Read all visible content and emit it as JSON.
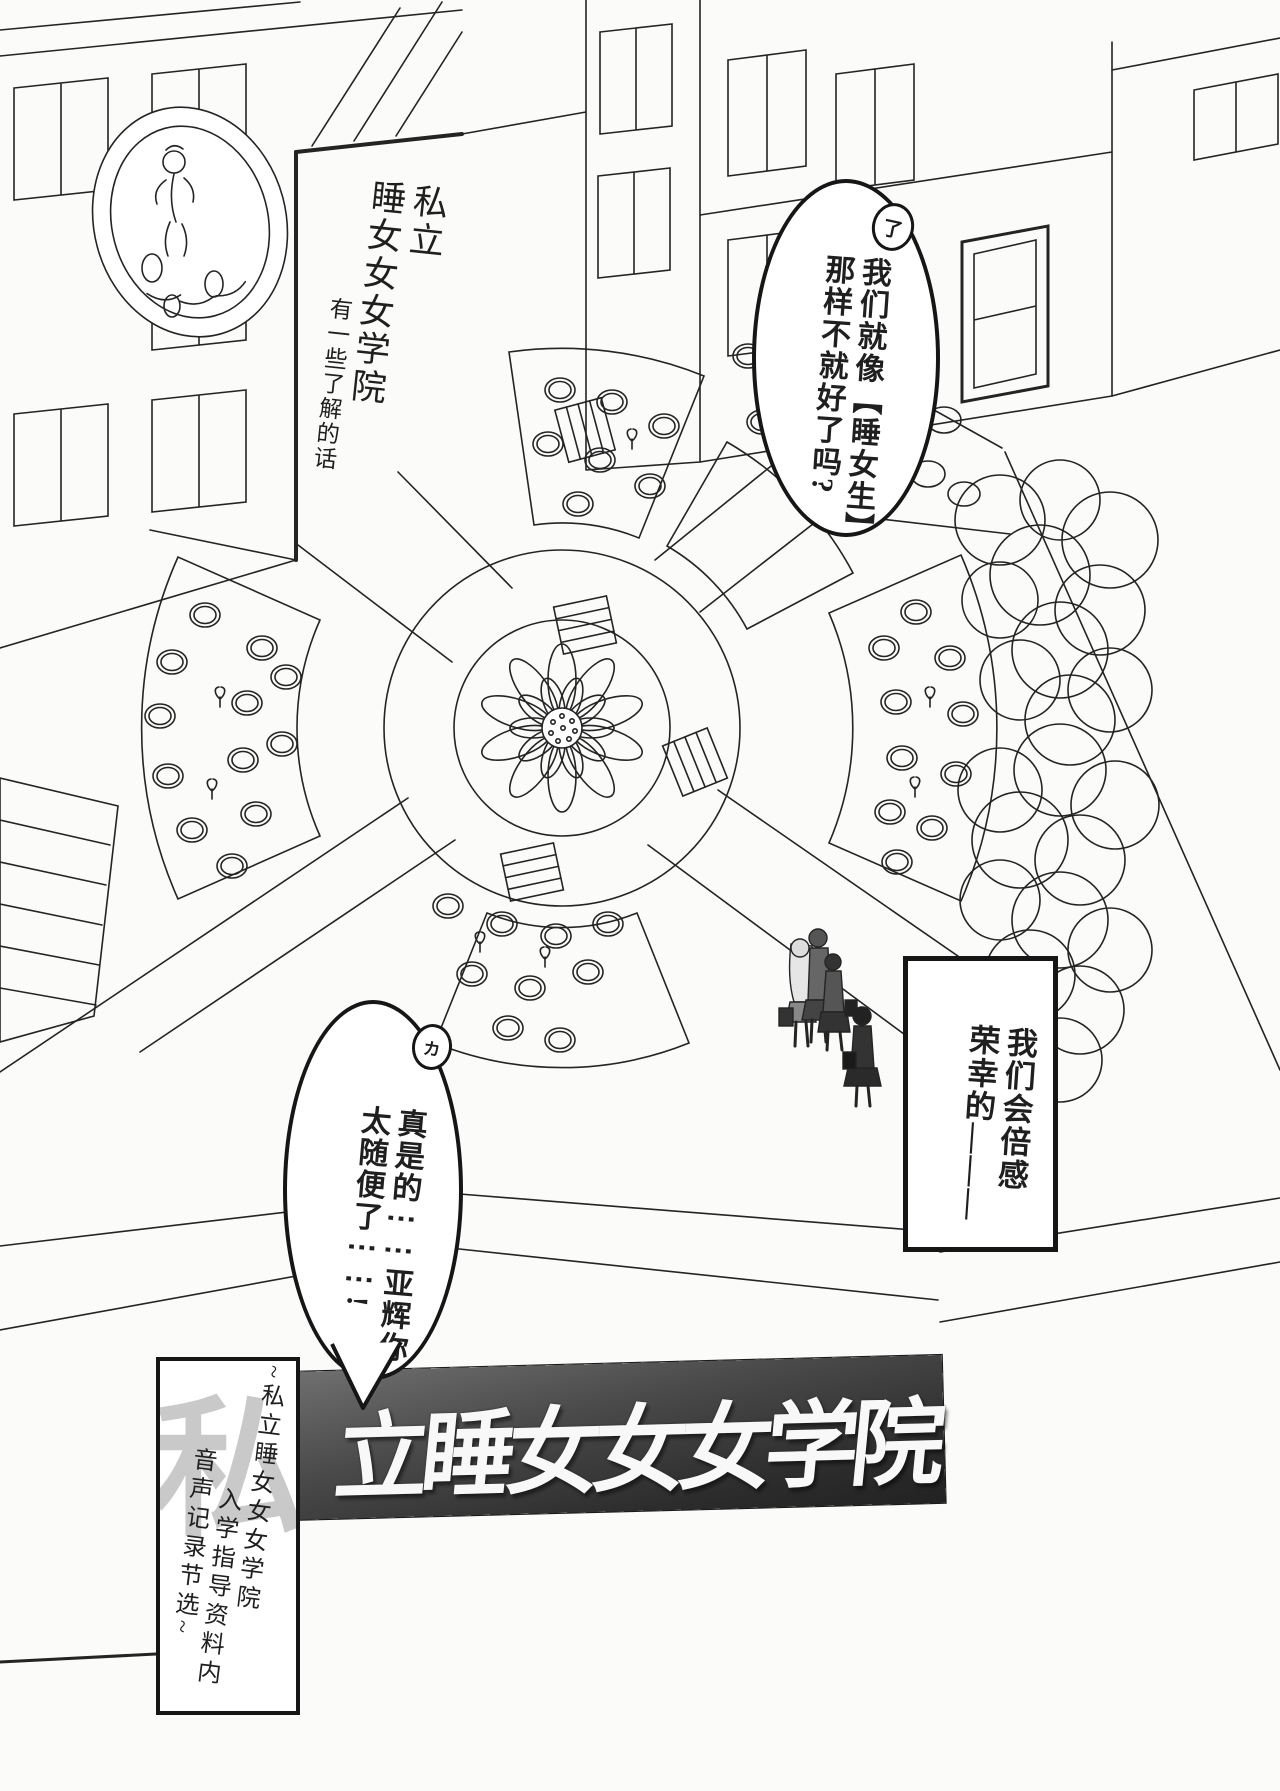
{
  "page": {
    "background": "#fbfbfa",
    "ink": "#1f1f1f"
  },
  "caption_top_left": {
    "col_right": "私立",
    "col_mid": "睡女女女学院",
    "col_left": "有一些了解的话"
  },
  "bubble_top_right": {
    "attachment_mark": "了",
    "col_right": "我们就像【睡女生】",
    "col_left": "那样不就好了吗?"
  },
  "box_right": {
    "col_right": "我们会倍感",
    "col_left": "荣幸的―――"
  },
  "bubble_bottom_left": {
    "attachment_mark": "カ",
    "col_right": "真是的⋮⋮亚辉你",
    "col_left": "太随便了⋮⋮!"
  },
  "banner": {
    "title": "立睡女女女学院",
    "bg_dark": "#2c2c2c"
  },
  "side_box": {
    "watermark": "私",
    "col_right": "~私立睡女女女学院",
    "col_mid": "入学指导资料内",
    "col_left": "音声记录节选~"
  }
}
